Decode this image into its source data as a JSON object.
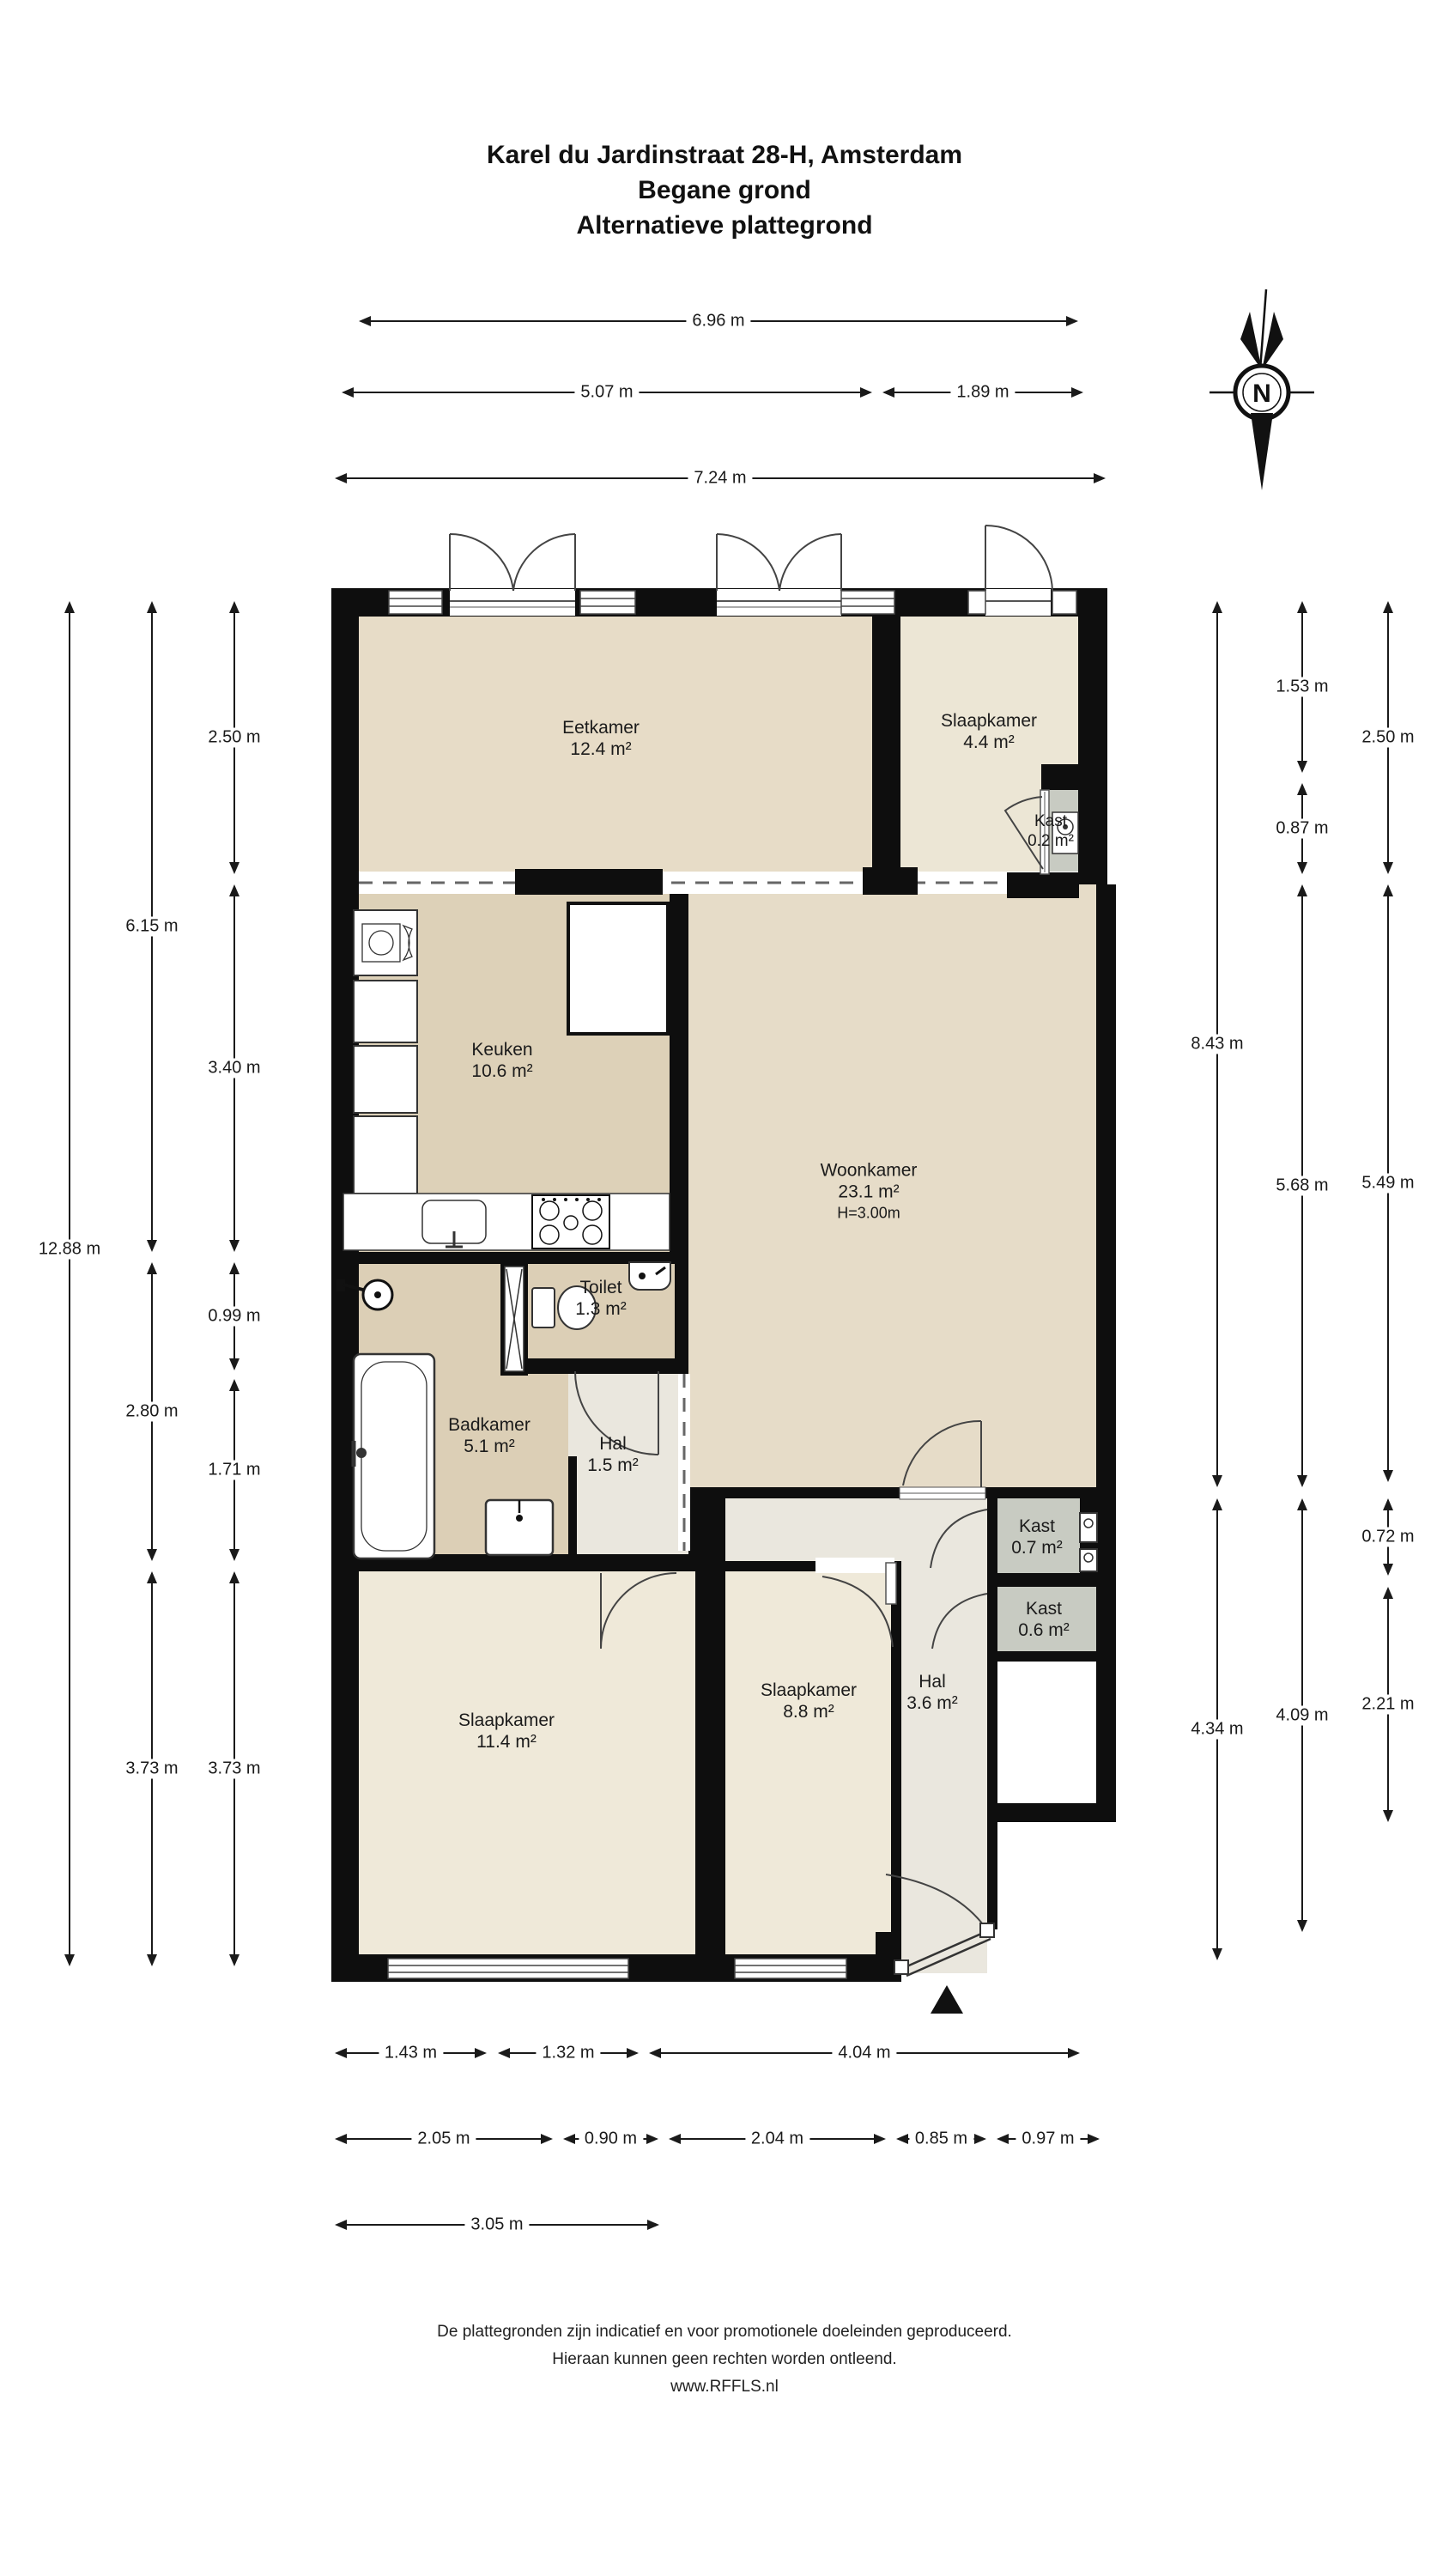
{
  "title": {
    "line1": "Karel du Jardinstraat 28-H, Amsterdam",
    "line2": "Begane grond",
    "line3": "Alternatieve plattegrond"
  },
  "compass": {
    "label": "N"
  },
  "rooms": {
    "eetkamer": {
      "name": "Eetkamer",
      "area": "12.4 m²"
    },
    "slaapkamer_klein": {
      "name": "Slaapkamer",
      "area": "4.4 m²"
    },
    "kast_02": {
      "name": "Kast",
      "area": "0.2 m²"
    },
    "keuken": {
      "name": "Keuken",
      "area": "10.6 m²"
    },
    "woonkamer": {
      "name": "Woonkamer",
      "area": "23.1 m²",
      "height": "H=3.00m"
    },
    "toilet": {
      "name": "Toilet",
      "area": "1.3 m²"
    },
    "badkamer": {
      "name": "Badkamer",
      "area": "5.1 m²"
    },
    "hal_klein": {
      "name": "Hal",
      "area": "1.5 m²"
    },
    "kast_07": {
      "name": "Kast",
      "area": "0.7 m²"
    },
    "kast_06": {
      "name": "Kast",
      "area": "0.6 m²"
    },
    "slaapkamer_groot": {
      "name": "Slaapkamer",
      "area": "11.4 m²"
    },
    "slaapkamer_midden": {
      "name": "Slaapkamer",
      "area": "8.8 m²"
    },
    "hal_groot": {
      "name": "Hal",
      "area": "3.6 m²"
    }
  },
  "dimensions": {
    "top": [
      "6.96 m",
      "5.07 m",
      "1.89 m",
      "7.24 m"
    ],
    "left": [
      "12.88 m",
      "6.15 m",
      "2.80 m",
      "3.73 m",
      "2.50 m",
      "3.40 m",
      "0.99 m",
      "1.71 m",
      "3.73 m"
    ],
    "right": [
      "8.43 m",
      "4.34 m",
      "1.53 m",
      "0.87 m",
      "5.68 m",
      "4.09 m",
      "2.50 m",
      "5.49 m",
      "0.72 m",
      "2.21 m"
    ],
    "bottom": [
      "1.43 m",
      "1.32 m",
      "4.04 m",
      "2.05 m",
      "0.90 m",
      "2.04 m",
      "0.85 m",
      "0.97 m",
      "3.05 m"
    ]
  },
  "footer": {
    "line1": "De plattegronden zijn indicatief en voor promotionele doeleinden geproduceerd.",
    "line2": "Hieraan kunnen geen rechten worden ontleend.",
    "line3": "www.RFFLS.nl"
  },
  "colors": {
    "wall": "#0e0e0e",
    "floor_living": "#e6dcc8",
    "floor_dining": "#e7dcc7",
    "floor_kitchen": "#ddd1b8",
    "floor_bath": "#dccfb6",
    "floor_bedroom_small": "#ece6d5",
    "floor_bedroom": "#efe9d9",
    "floor_hall": "#eae7de",
    "floor_closet": "#c8cbc2"
  }
}
